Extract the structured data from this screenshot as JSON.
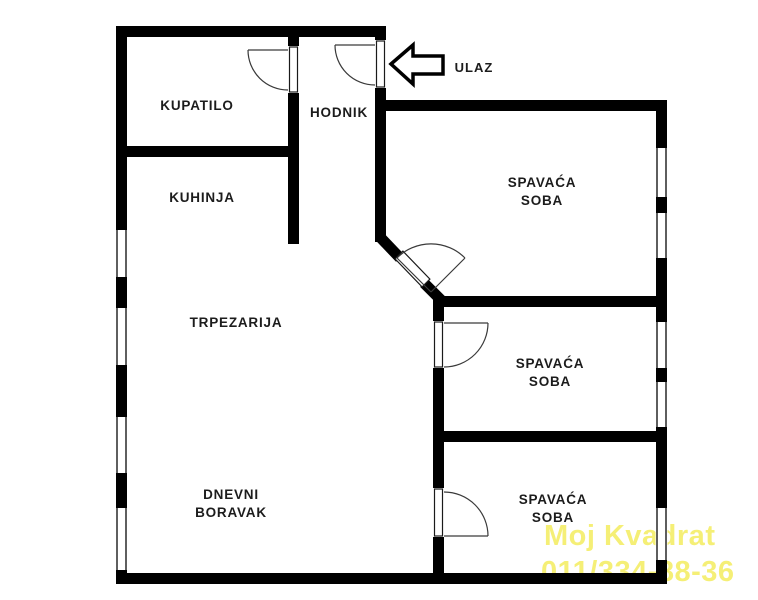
{
  "plan": {
    "type": "apartment-floor-plan",
    "rooms": [
      {
        "id": "kupatilo",
        "label": "KUPATILO"
      },
      {
        "id": "hodnik",
        "label": "HODNIK"
      },
      {
        "id": "kuhinja",
        "label": "KUHINJA"
      },
      {
        "id": "trpezarija",
        "label": "TRPEZARIJA"
      },
      {
        "id": "dnevni-boravak",
        "label_line1": "DNEVNI",
        "label_line2": "BORAVAK"
      },
      {
        "id": "spavaca-soba-top",
        "label_line1": "SPAVAĆA",
        "label_line2": "SOBA"
      },
      {
        "id": "spavaca-soba-middle",
        "label_line1": "SPAVAĆA",
        "label_line2": "SOBA"
      },
      {
        "id": "spavaca-soba-bottom",
        "label_line1": "SPAVAĆA",
        "label_line2": "SOBA"
      }
    ],
    "entrance": {
      "label": "ULAZ",
      "arrow_direction": "left"
    },
    "features": {
      "doors": 5,
      "windows_left_wall": 4,
      "windows_right_wall": 5
    }
  },
  "watermark": {
    "brand": "Moj Kvadrat",
    "phone": "011/334-88-36"
  },
  "colors": {
    "wall": "#000000",
    "label_text": "#1c1c1c",
    "door_line": "#3a3a3a",
    "watermark": "#f5ef76",
    "background": "#ffffff"
  }
}
